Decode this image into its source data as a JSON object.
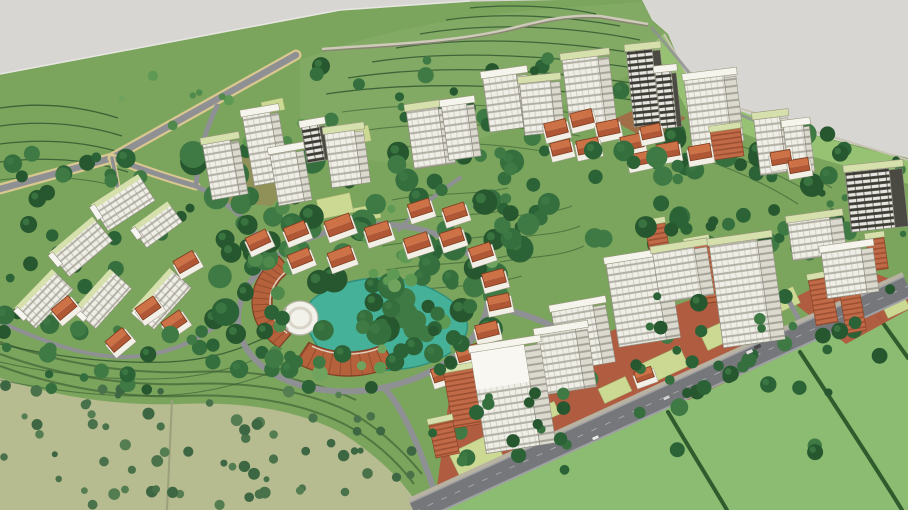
{
  "meta": {
    "scene_label": "Aerial 3D masterplan rendering of a hillside campus development with residential towers, orange-roof villages, a central lake, crescent building and perimeter roads",
    "style": "sketchup-architectural-render"
  },
  "colors": {
    "sky": "#d7d6d3",
    "land": "#7ba45c",
    "hillland": "#86ab66",
    "olive": "#b7bb90",
    "fieldBR": "#8cbb72",
    "verge": "#97c173",
    "hedge": "#2f5c2d",
    "contour": "#2d5430",
    "road": "#8f9094",
    "roadEdge": "#d8c78f",
    "mainRoad": "#75777b",
    "mainRoadEdge": "#9fa0a3",
    "sidewalk": "#b8b2a3",
    "lake": "#45b199",
    "lakeEdge": "#2f8f7c",
    "dome": "#f2f1ea",
    "crescent": "#b5623c",
    "crescentDark": "#7e3f24",
    "plaza": "#b2593f",
    "lawn": "#cbd993",
    "towerFace": "#efeee7",
    "towerBand": "#b2b0a4",
    "towerSide": "#dcdacf",
    "towerSideBand": "#a5a398",
    "towerStroke": "#8f8d80",
    "darkFace": "#3b3a33",
    "darkLight": "#e6e5df",
    "darkSide": "#4a4942",
    "roofGreen": "#d6e0ac",
    "roofWhite": "#f5f4ed",
    "orange": "#c06a48",
    "orangeDark": "#9c4f31",
    "houseTop": "#cd7146",
    "houseBottom": "#b05836",
    "houseLine": "#7e3c1f",
    "houseWall": "#f1efe6",
    "wallLight": "#cfcabb",
    "wallDark": "#8a8474"
  },
  "palettes": {
    "dark": [
      "#2b6337",
      "#356f3e",
      "#27572f",
      "#3f7a45"
    ],
    "light": [
      "#5f9a55",
      "#6fa35e",
      "#4f8a4c"
    ],
    "olive": [
      "#49724b",
      "#3d6642",
      "#557d52"
    ]
  },
  "scene": {
    "tree_regions": [
      {
        "x": 190,
        "y": 150,
        "w": 330,
        "h": 185,
        "n": 95,
        "rmin": 6,
        "rmax": 14,
        "pal": "dark",
        "seed": 7
      },
      {
        "x": 300,
        "y": 58,
        "w": 330,
        "h": 95,
        "n": 40,
        "rmin": 4,
        "rmax": 9,
        "pal": "dark",
        "seed": 11
      },
      {
        "x": 650,
        "y": 130,
        "w": 215,
        "h": 130,
        "n": 55,
        "rmin": 5,
        "rmax": 12,
        "pal": "dark",
        "seed": 13
      },
      {
        "x": 0,
        "y": 150,
        "w": 200,
        "h": 215,
        "n": 40,
        "rmin": 4,
        "rmax": 10,
        "pal": "dark",
        "seed": 17
      },
      {
        "x": 255,
        "y": 205,
        "w": 240,
        "h": 175,
        "n": 28,
        "rmin": 4,
        "rmax": 8,
        "pal": "light",
        "seed": 19
      },
      {
        "x": 430,
        "y": 295,
        "w": 430,
        "h": 165,
        "n": 40,
        "rmin": 4,
        "rmax": 9,
        "pal": "dark",
        "seed": 23
      },
      {
        "x": 0,
        "y": 385,
        "w": 415,
        "h": 120,
        "n": 70,
        "rmin": 3,
        "rmax": 6,
        "pal": "olive",
        "seed": 29
      },
      {
        "x": 120,
        "y": 58,
        "w": 190,
        "h": 100,
        "n": 14,
        "rmin": 3,
        "rmax": 6,
        "pal": "light",
        "seed": 31
      },
      {
        "x": 812,
        "y": 148,
        "w": 92,
        "h": 95,
        "n": 14,
        "rmin": 3,
        "rmax": 7,
        "pal": "dark",
        "seed": 37
      },
      {
        "x": 225,
        "y": 318,
        "w": 245,
        "h": 72,
        "n": 24,
        "rmin": 5,
        "rmax": 10,
        "pal": "dark",
        "seed": 41,
        "front": 1
      },
      {
        "x": 38,
        "y": 328,
        "w": 175,
        "h": 62,
        "n": 16,
        "rmin": 4,
        "rmax": 9,
        "pal": "dark",
        "seed": 43,
        "front": 1
      },
      {
        "x": 428,
        "y": 385,
        "w": 170,
        "h": 85,
        "n": 14,
        "rmin": 4,
        "rmax": 8,
        "pal": "dark",
        "seed": 47,
        "front": 1
      },
      {
        "x": 488,
        "y": 148,
        "w": 215,
        "h": 95,
        "n": 26,
        "rmin": 5,
        "rmax": 11,
        "pal": "dark",
        "seed": 53,
        "front": 1
      },
      {
        "x": 600,
        "y": 286,
        "w": 300,
        "h": 130,
        "n": 26,
        "rmin": 4,
        "rmax": 9,
        "pal": "dark",
        "seed": 59,
        "front": 1
      }
    ],
    "buildings": [
      {
        "t": "tower",
        "x": 410,
        "y": 107,
        "w": 32,
        "h": 60,
        "r": -8,
        "roof": "g"
      },
      {
        "t": "tower",
        "x": 445,
        "y": 103,
        "w": 25,
        "h": 56,
        "r": -8,
        "roof": "w"
      },
      {
        "t": "tower",
        "x": 486,
        "y": 74,
        "w": 34,
        "h": 56,
        "r": -8,
        "roof": "w"
      },
      {
        "t": "tower",
        "x": 522,
        "y": 80,
        "w": 31,
        "h": 54,
        "r": -6,
        "roof": "g"
      },
      {
        "t": "tower",
        "x": 566,
        "y": 56,
        "w": 36,
        "h": 72,
        "r": -7,
        "roof": "g"
      },
      {
        "t": "dark",
        "x": 630,
        "y": 48,
        "w": 26,
        "h": 78,
        "r": -6,
        "roof": "g"
      },
      {
        "t": "dark",
        "x": 658,
        "y": 70,
        "w": 16,
        "h": 58,
        "r": -6,
        "roof": "w"
      },
      {
        "t": "tower",
        "x": 688,
        "y": 76,
        "w": 40,
        "h": 70,
        "r": -7,
        "roof": "w"
      },
      {
        "t": "orange",
        "x": 712,
        "y": 128,
        "w": 30,
        "h": 30,
        "r": -8,
        "roof": "g"
      },
      {
        "t": "tower",
        "x": 757,
        "y": 116,
        "w": 26,
        "h": 58,
        "r": -7,
        "roof": "g"
      },
      {
        "t": "tower",
        "x": 786,
        "y": 124,
        "w": 20,
        "h": 50,
        "r": -7,
        "roof": "w"
      },
      {
        "t": "dark",
        "x": 848,
        "y": 168,
        "w": 44,
        "h": 62,
        "r": -6,
        "roof": "g"
      },
      {
        "t": "tower",
        "x": 248,
        "y": 112,
        "w": 28,
        "h": 72,
        "r": -10,
        "roof": "w"
      },
      {
        "t": "dark",
        "x": 304,
        "y": 124,
        "w": 18,
        "h": 38,
        "r": -10,
        "roof": "w"
      },
      {
        "t": "tower",
        "x": 207,
        "y": 140,
        "w": 28,
        "h": 58,
        "r": -10,
        "roof": "g"
      },
      {
        "t": "tower",
        "x": 274,
        "y": 150,
        "w": 26,
        "h": 54,
        "r": -10,
        "roof": "w"
      },
      {
        "t": "tower",
        "x": 328,
        "y": 130,
        "w": 30,
        "h": 56,
        "r": -8,
        "roof": "g"
      },
      {
        "t": "house",
        "x": 545,
        "y": 121,
        "w": 22,
        "h": 14,
        "r": -14
      },
      {
        "t": "house",
        "x": 571,
        "y": 111,
        "w": 22,
        "h": 14,
        "r": -14
      },
      {
        "t": "house",
        "x": 597,
        "y": 121,
        "w": 22,
        "h": 14,
        "r": -12
      },
      {
        "t": "house",
        "x": 577,
        "y": 139,
        "w": 22,
        "h": 14,
        "r": -12
      },
      {
        "t": "house",
        "x": 551,
        "y": 141,
        "w": 20,
        "h": 13,
        "r": -14
      },
      {
        "t": "house",
        "x": 621,
        "y": 135,
        "w": 22,
        "h": 14,
        "r": -12
      },
      {
        "t": "house",
        "x": 641,
        "y": 125,
        "w": 20,
        "h": 13,
        "r": -12
      },
      {
        "t": "house",
        "x": 657,
        "y": 143,
        "w": 22,
        "h": 14,
        "r": -10
      },
      {
        "t": "house",
        "x": 689,
        "y": 145,
        "w": 22,
        "h": 14,
        "r": -10
      },
      {
        "t": "house",
        "x": 629,
        "y": 153,
        "w": 20,
        "h": 12,
        "r": -12
      },
      {
        "t": "house",
        "x": 771,
        "y": 151,
        "w": 20,
        "h": 13,
        "r": -10
      },
      {
        "t": "house",
        "x": 789,
        "y": 159,
        "w": 20,
        "h": 13,
        "r": -10
      },
      {
        "t": "slab",
        "x": 96,
        "y": 190,
        "w": 56,
        "h": 28,
        "r": -33
      },
      {
        "t": "slab",
        "x": 136,
        "y": 215,
        "w": 44,
        "h": 22,
        "r": -36
      },
      {
        "t": "slab",
        "x": 54,
        "y": 234,
        "w": 56,
        "h": 28,
        "r": -40
      },
      {
        "t": "slab",
        "x": 18,
        "y": 287,
        "w": 54,
        "h": 26,
        "r": -46
      },
      {
        "t": "slab",
        "x": 77,
        "y": 287,
        "w": 54,
        "h": 26,
        "r": -48
      },
      {
        "t": "slab",
        "x": 135,
        "y": 287,
        "w": 56,
        "h": 26,
        "r": -48
      },
      {
        "t": "house",
        "x": 175,
        "y": 255,
        "w": 22,
        "h": 14,
        "r": -30
      },
      {
        "t": "house",
        "x": 137,
        "y": 301,
        "w": 22,
        "h": 14,
        "r": -35
      },
      {
        "t": "house",
        "x": 163,
        "y": 315,
        "w": 22,
        "h": 14,
        "r": -35
      },
      {
        "t": "house",
        "x": 53,
        "y": 301,
        "w": 22,
        "h": 14,
        "r": -40
      },
      {
        "t": "house",
        "x": 107,
        "y": 333,
        "w": 22,
        "h": 14,
        "r": -40
      },
      {
        "t": "house",
        "x": 247,
        "y": 233,
        "w": 22,
        "h": 14,
        "r": -25
      },
      {
        "t": "house",
        "x": 285,
        "y": 224,
        "w": 22,
        "h": 14,
        "r": -22
      },
      {
        "t": "house",
        "x": 326,
        "y": 217,
        "w": 26,
        "h": 16,
        "r": -20
      },
      {
        "t": "house",
        "x": 366,
        "y": 224,
        "w": 24,
        "h": 15,
        "r": -18
      },
      {
        "t": "house",
        "x": 405,
        "y": 235,
        "w": 24,
        "h": 15,
        "r": -18
      },
      {
        "t": "house",
        "x": 441,
        "y": 230,
        "w": 22,
        "h": 14,
        "r": -18
      },
      {
        "t": "house",
        "x": 470,
        "y": 245,
        "w": 22,
        "h": 14,
        "r": -18
      },
      {
        "t": "house",
        "x": 483,
        "y": 271,
        "w": 22,
        "h": 14,
        "r": -15
      },
      {
        "t": "house",
        "x": 488,
        "y": 295,
        "w": 22,
        "h": 14,
        "r": -12
      },
      {
        "t": "house",
        "x": 476,
        "y": 323,
        "w": 22,
        "h": 14,
        "r": -14
      },
      {
        "t": "house",
        "x": 457,
        "y": 346,
        "w": 22,
        "h": 14,
        "r": -16
      },
      {
        "t": "house",
        "x": 432,
        "y": 366,
        "w": 22,
        "h": 14,
        "r": -18
      },
      {
        "t": "house",
        "x": 289,
        "y": 251,
        "w": 22,
        "h": 14,
        "r": -22
      },
      {
        "t": "house",
        "x": 329,
        "y": 249,
        "w": 24,
        "h": 15,
        "r": -20
      },
      {
        "t": "house",
        "x": 409,
        "y": 201,
        "w": 22,
        "h": 14,
        "r": -18
      },
      {
        "t": "house",
        "x": 444,
        "y": 205,
        "w": 22,
        "h": 14,
        "r": -18
      },
      {
        "t": "house",
        "x": 635,
        "y": 369,
        "w": 18,
        "h": 11,
        "r": -20
      },
      {
        "t": "orange",
        "x": 648,
        "y": 222,
        "w": 20,
        "h": 40,
        "r": -10,
        "roof": "g"
      },
      {
        "t": "orange",
        "x": 690,
        "y": 240,
        "w": 24,
        "h": 64,
        "r": -10,
        "roof": "g"
      },
      {
        "t": "orange",
        "x": 730,
        "y": 286,
        "w": 26,
        "h": 44,
        "r": -12,
        "roof": "g"
      },
      {
        "t": "orange",
        "x": 812,
        "y": 276,
        "w": 22,
        "h": 48,
        "r": -10,
        "roof": "g"
      },
      {
        "t": "orange",
        "x": 843,
        "y": 292,
        "w": 20,
        "h": 40,
        "r": -10,
        "roof": "g"
      },
      {
        "t": "orange",
        "x": 868,
        "y": 236,
        "w": 18,
        "h": 34,
        "r": -8,
        "roof": "g"
      },
      {
        "t": "tower",
        "x": 556,
        "y": 306,
        "w": 42,
        "h": 62,
        "r": -10,
        "roof": "w"
      },
      {
        "t": "tower",
        "x": 612,
        "y": 258,
        "w": 48,
        "h": 86,
        "r": -9,
        "roof": "w"
      },
      {
        "t": "tower",
        "x": 656,
        "y": 248,
        "w": 42,
        "h": 52,
        "r": -9,
        "roof": "g"
      },
      {
        "t": "tower",
        "x": 716,
        "y": 240,
        "w": 48,
        "h": 105,
        "r": -8,
        "roof": "g"
      },
      {
        "t": "tower",
        "x": 790,
        "y": 218,
        "w": 42,
        "h": 40,
        "r": -8,
        "roof": "g"
      },
      {
        "t": "tower",
        "x": 824,
        "y": 248,
        "w": 40,
        "h": 48,
        "r": -8,
        "roof": "w"
      },
      {
        "t": "orange",
        "x": 448,
        "y": 368,
        "w": 34,
        "h": 58,
        "r": -10,
        "roof": "g"
      },
      {
        "t": "tower",
        "x": 540,
        "y": 330,
        "w": 40,
        "h": 62,
        "r": -9,
        "roof": "w"
      },
      {
        "t": "tower",
        "x": 478,
        "y": 346,
        "w": 54,
        "h": 104,
        "r": -9,
        "roof": "w",
        "bright": 1
      },
      {
        "t": "orange",
        "x": 432,
        "y": 420,
        "w": 24,
        "h": 36,
        "r": -12,
        "roof": "g"
      }
    ],
    "lawns": [
      [
        318,
        196,
        34,
        20,
        -12
      ],
      [
        354,
        206,
        26,
        14,
        -10
      ],
      [
        340,
        128,
        30,
        16,
        -12
      ],
      [
        262,
        100,
        22,
        12,
        -12
      ],
      [
        452,
        442,
        48,
        26,
        -26
      ],
      [
        508,
        452,
        30,
        16,
        -26
      ],
      [
        532,
        406,
        26,
        14,
        -24
      ],
      [
        600,
        382,
        30,
        16,
        -25
      ],
      [
        644,
        354,
        42,
        22,
        -25
      ],
      [
        702,
        324,
        36,
        20,
        -25
      ],
      [
        768,
        292,
        30,
        18,
        -25
      ],
      [
        838,
        262,
        28,
        16,
        -25
      ],
      [
        884,
        300,
        24,
        14,
        -25
      ]
    ],
    "cars": [
      {
        "x": 592,
        "y": 436,
        "c": "#e6e6e6"
      },
      {
        "x": 663,
        "y": 396,
        "c": "#cfcfcf"
      },
      {
        "x": 746,
        "y": 350,
        "c": "#e0e0e0"
      },
      {
        "x": 754,
        "y": 345,
        "c": "#4a4a4a"
      }
    ],
    "crescent": [
      {
        "cx": 322,
        "cy": 302,
        "rx1": 50,
        "ry1": 40,
        "rx2": 70,
        "ry2": 58,
        "t1": 128,
        "t2": 232
      },
      {
        "cx": 348,
        "cy": 296,
        "rx1": 70,
        "ry1": 56,
        "rx2": 94,
        "ry2": 80,
        "t1": 60,
        "t2": 124
      }
    ]
  }
}
